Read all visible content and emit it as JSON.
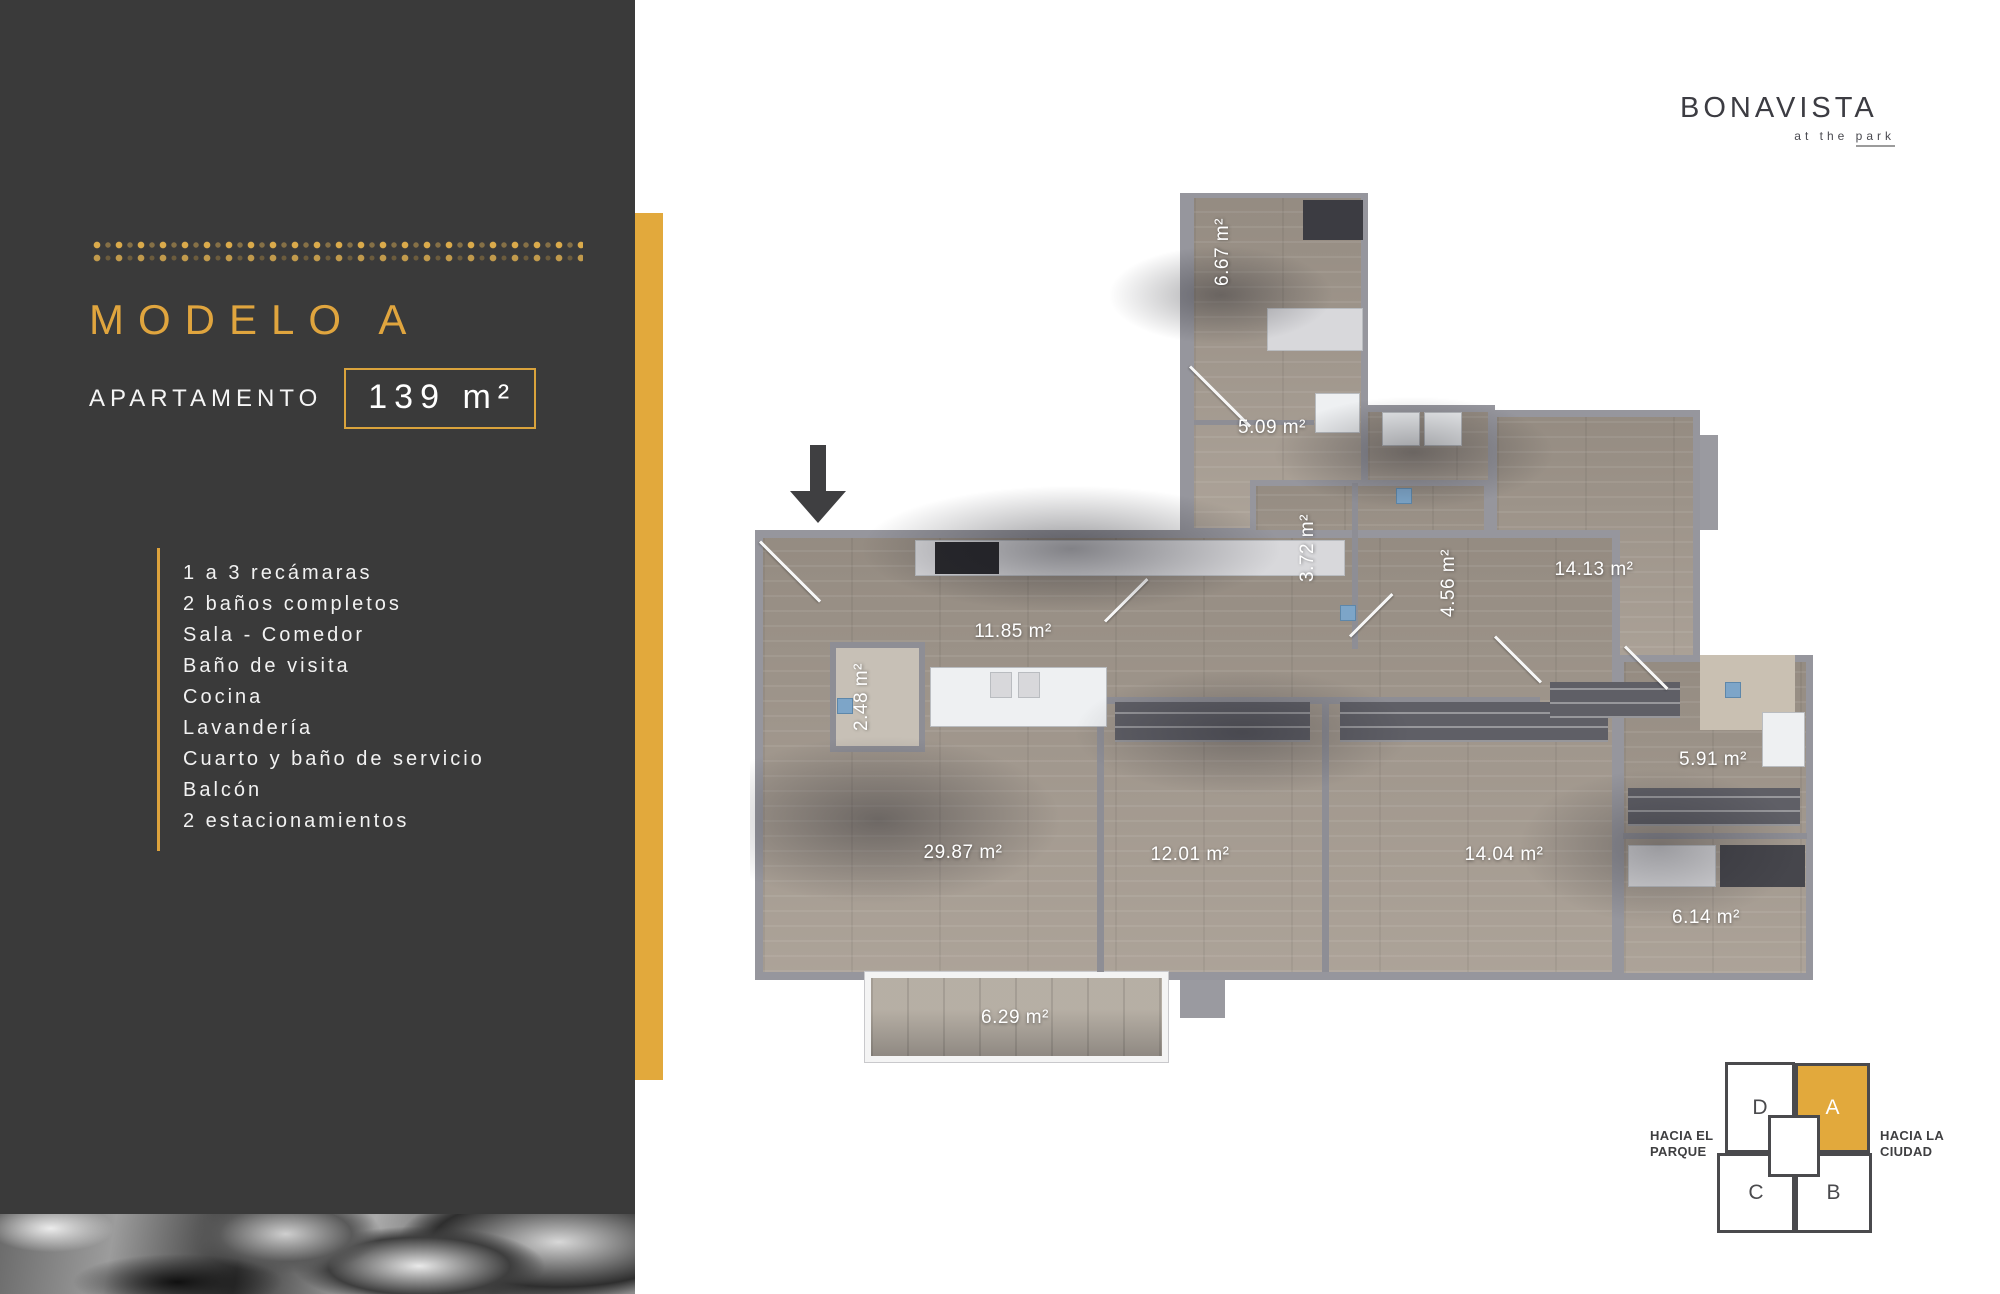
{
  "sidebar": {
    "title": "MODELO A",
    "subtitle": "APARTAMENTO",
    "area_value": "139 m²",
    "features": [
      "1 a 3 recámaras",
      "2 baños completos",
      "Sala - Comedor",
      "Baño de visita",
      "Cocina",
      "Lavandería",
      "Cuarto y baño de servicio",
      "Balcón",
      "2 estacionamientos"
    ]
  },
  "logo": {
    "name": "BONAVISTA",
    "tagline_prefix": "at the",
    "tagline_underlined": "park"
  },
  "plan": {
    "rooms": [
      {
        "area": "6.67 m²"
      },
      {
        "area": "5.09 m²"
      },
      {
        "area": "3.72 m²"
      },
      {
        "area": "4.56 m²"
      },
      {
        "area": "14.13 m²"
      },
      {
        "area": "11.85 m²"
      },
      {
        "area": "2.48 m²"
      },
      {
        "area": "5.91 m²"
      },
      {
        "area": "29.87 m²"
      },
      {
        "area": "12.01 m²"
      },
      {
        "area": "14.04 m²"
      },
      {
        "area": "6.14 m²"
      },
      {
        "area": "6.29 m²"
      }
    ]
  },
  "minimap": {
    "left_label": "HACIA EL PARQUE",
    "right_label": "HACIA LA CIUDAD",
    "units": [
      {
        "label": "D"
      },
      {
        "label": "A"
      },
      {
        "label": "C"
      },
      {
        "label": "B"
      }
    ],
    "highlighted_unit": "A"
  },
  "colors": {
    "accent_gold": "#E2A93C",
    "sidebar_dark": "#3A3A3A",
    "minimap_outline": "#4A4A4D"
  }
}
